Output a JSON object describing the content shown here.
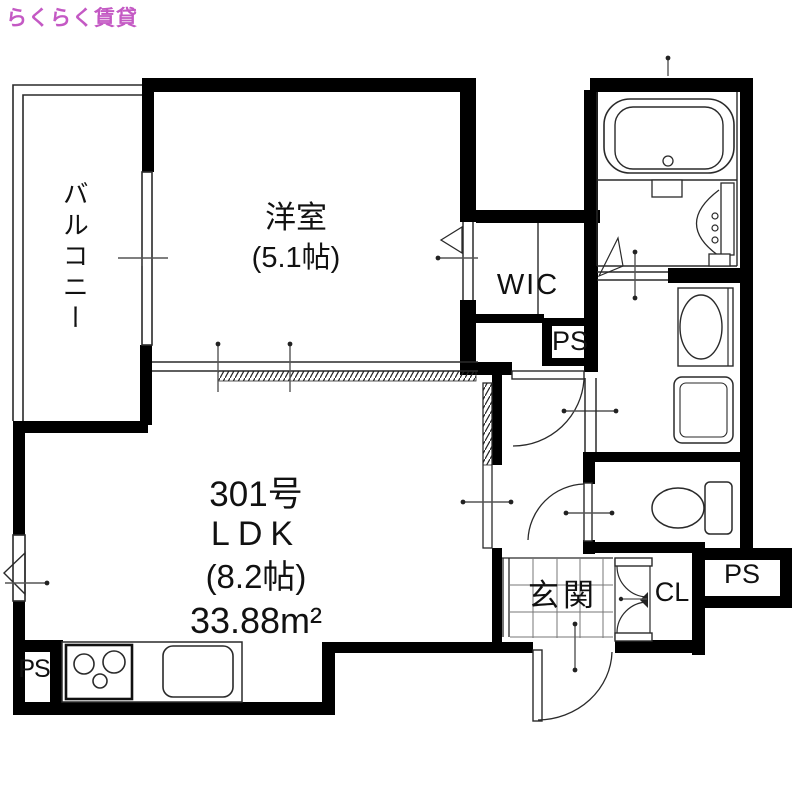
{
  "watermark": {
    "text": "らくらく賃貸",
    "color": "#c459c4"
  },
  "unit": {
    "number_label": "301号",
    "type_label": "LDK",
    "size_label": "(8.2帖)",
    "area_label": "33.88m²"
  },
  "rooms": {
    "balcony": "バルコニー",
    "western_room": "洋室",
    "western_room_size": "(5.1帖)",
    "walk_in_closet": "WIC",
    "entrance": "玄関",
    "closet": "CL",
    "pipe_space_upper": "PS",
    "pipe_space_lower_right": "PS",
    "pipe_space_lower_left": "PS"
  },
  "colors": {
    "wall": "#000000",
    "line": "#2a2a2a",
    "background": "#ffffff"
  }
}
